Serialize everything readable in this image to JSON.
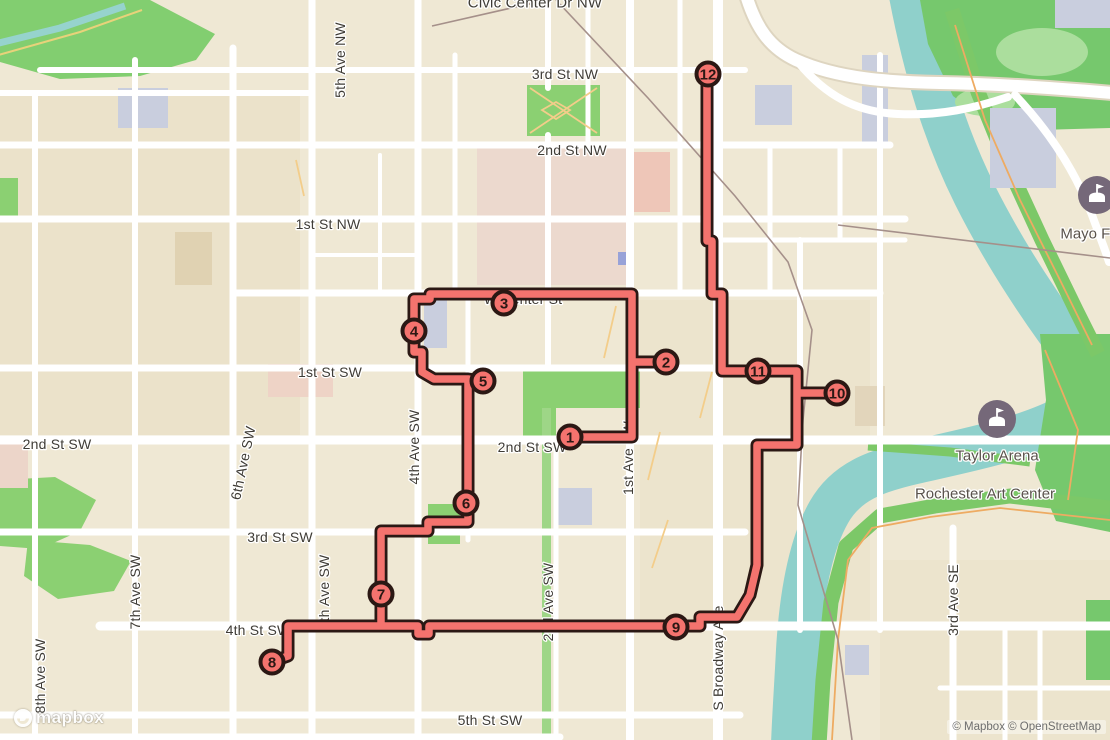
{
  "attribution": {
    "text": "© Mapbox © OpenStreetMap"
  },
  "logo": {
    "text": "mapbox"
  },
  "colors": {
    "land": "#efe8d4",
    "road": "#ffffff",
    "park_bright": "#8bd072",
    "park_medium": "#76c86d",
    "park_pale": "#abde9d",
    "water": "#8fd0cb",
    "campus_pink": "#ecd9ce",
    "building_pink": "#eec6b8",
    "building_lavender": "#c9cede",
    "route": "#f4736e",
    "route_casing": "#2b1814",
    "poi_badge": "#756879",
    "label_gray": "#3f3c36"
  },
  "street_labels": [
    {
      "text": "Civic Center Dr NW",
      "x": 535,
      "y": 2,
      "rot": 0,
      "size": 15
    },
    {
      "text": "3rd St NW",
      "x": 565,
      "y": 74,
      "rot": 0
    },
    {
      "text": "2nd St NW",
      "x": 572,
      "y": 150,
      "rot": 0
    },
    {
      "text": "1st St NW",
      "x": 328,
      "y": 224,
      "rot": 0
    },
    {
      "text": "W Center St",
      "x": 523,
      "y": 299,
      "rot": 0
    },
    {
      "text": "1st St SW",
      "x": 330,
      "y": 372,
      "rot": 0
    },
    {
      "text": "2nd St SW",
      "x": 57,
      "y": 444,
      "rot": 0
    },
    {
      "text": "2nd St SW",
      "x": 532,
      "y": 447,
      "rot": 0
    },
    {
      "text": "3rd St SW",
      "x": 280,
      "y": 537,
      "rot": 0
    },
    {
      "text": "4th St SW",
      "x": 258,
      "y": 630,
      "rot": 0
    },
    {
      "text": "5th St SW",
      "x": 490,
      "y": 720,
      "rot": 0
    },
    {
      "text": "5th Ave NW",
      "x": 340,
      "y": 60,
      "rot": -90
    },
    {
      "text": "4th Ave SW",
      "x": 414,
      "y": 447,
      "rot": -90
    },
    {
      "text": "6th Ave SW",
      "x": 243,
      "y": 463,
      "rot": -78
    },
    {
      "text": "7th Ave SW",
      "x": 135,
      "y": 592,
      "rot": -90
    },
    {
      "text": "8th Ave SW",
      "x": 40,
      "y": 676,
      "rot": -90
    },
    {
      "text": "5th Ave SW",
      "x": 324,
      "y": 592,
      "rot": -90
    },
    {
      "text": "2nd Ave SW",
      "x": 548,
      "y": 602,
      "rot": -90
    },
    {
      "text": "1st Ave SW",
      "x": 628,
      "y": 458,
      "rot": -90
    },
    {
      "text": "S Broadway Ave",
      "x": 718,
      "y": 658,
      "rot": -90
    },
    {
      "text": "3rd Ave SE",
      "x": 953,
      "y": 600,
      "rot": -90
    }
  ],
  "pois": [
    {
      "label": "Taylor Arena",
      "x": 997,
      "y": 419,
      "badge": true,
      "label_dy": 36
    },
    {
      "label": "Mayo Field",
      "x": 1097,
      "y": 195,
      "badge": true,
      "label_dy": 38
    },
    {
      "label": "Rochester Art Center",
      "x": 985,
      "y": 493,
      "badge": false,
      "label_dy": 0
    }
  ],
  "route": {
    "color": "#f4736e",
    "casing": "#2b1814",
    "markers": [
      {
        "n": "1",
        "x": 570,
        "y": 437
      },
      {
        "n": "2",
        "x": 666,
        "y": 362
      },
      {
        "n": "3",
        "x": 504,
        "y": 303
      },
      {
        "n": "4",
        "x": 414,
        "y": 331
      },
      {
        "n": "5",
        "x": 483,
        "y": 381
      },
      {
        "n": "6",
        "x": 466,
        "y": 503
      },
      {
        "n": "7",
        "x": 381,
        "y": 594
      },
      {
        "n": "8",
        "x": 272,
        "y": 662
      },
      {
        "n": "9",
        "x": 676,
        "y": 627
      },
      {
        "n": "10",
        "x": 837,
        "y": 393
      },
      {
        "n": "11",
        "x": 758,
        "y": 371
      },
      {
        "n": "12",
        "x": 708,
        "y": 74
      }
    ]
  }
}
